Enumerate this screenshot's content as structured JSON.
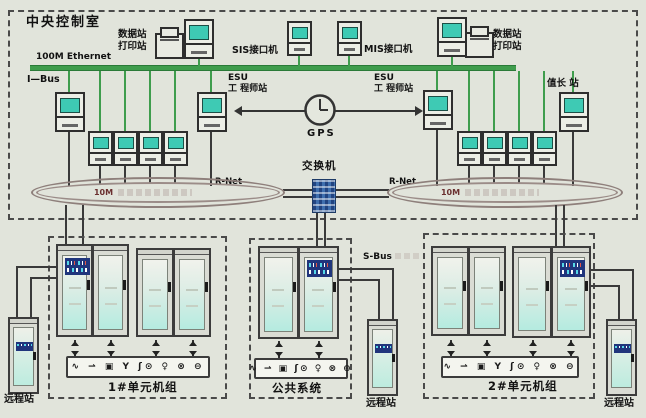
{
  "control_room": {
    "title": "中央控制室",
    "ethernet": "100M Ethernet",
    "ibus": "I—Bus",
    "data_print_1": "数据站",
    "data_print_2": "打印站",
    "sis": "SIS接口机",
    "mis": "MIS接口机",
    "esu_1": "ESU",
    "esu_2": "工 程师站",
    "gps": "GPS",
    "shift_leader": "值长 站",
    "switch": "交换机",
    "rnet": "R-Net",
    "ring_speed": "10M"
  },
  "plant": {
    "sbus": "S-Bus",
    "unit1": "1#单元机组",
    "common": "公共系统",
    "unit2": "2#单元机组",
    "remote": "远程站",
    "instrument_icons_unit": "∿ ⇀ ▣ Y ʃ⊙ ♀ ⊗ ⊖",
    "instrument_icons_common": "∿ ⇀ ▣ ʃ⊙ ♀ ⊗ ⊖"
  },
  "colors": {
    "background": "#e1e4db",
    "ethernet_green": "#3f9d4d",
    "monitor_teal": "#3ecab4",
    "controller_navy": "#20357c",
    "switch_blue": "#3f6fae",
    "ring_outline": "#8e7f7b",
    "line_dark": "#3a3a3a",
    "cabinet_screen": "#b5ebe0"
  }
}
